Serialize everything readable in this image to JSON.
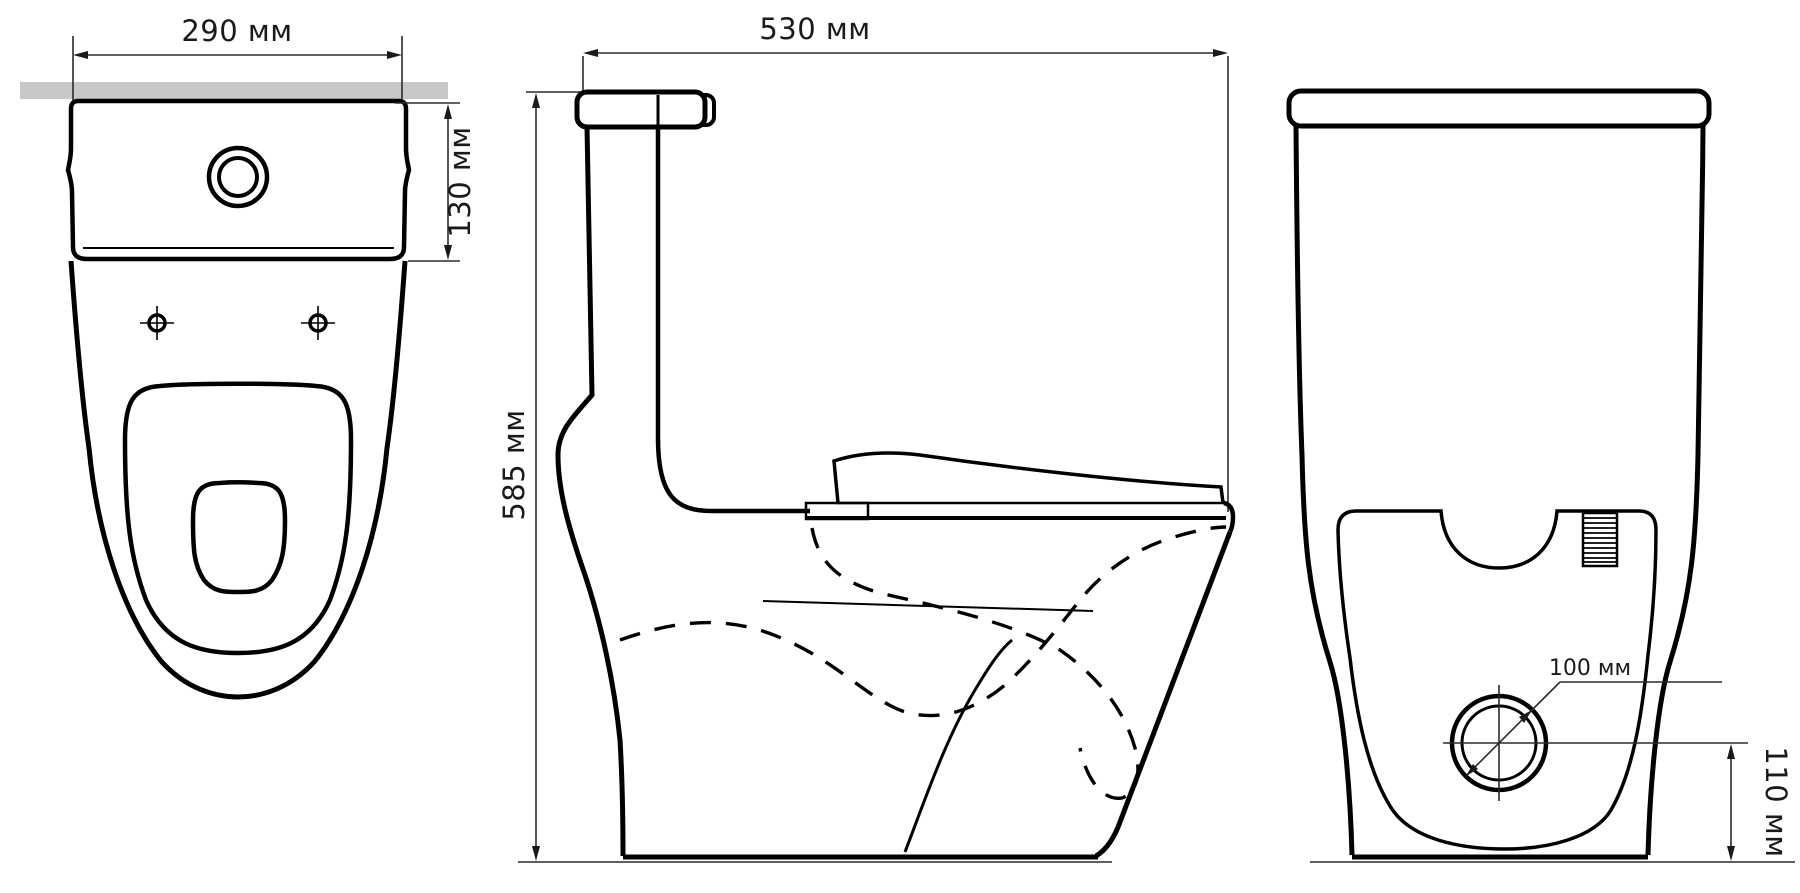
{
  "drawing": {
    "kind": "technical dimensional drawing",
    "subject": "one-piece toilet shown in three orthographic views (top, side, front)",
    "unit": "мм",
    "dimensions": {
      "top_width": "290 мм",
      "tank_depth": "130 мм",
      "side_depth": "530 мм",
      "side_height": "585 мм",
      "outlet_diameter": "100 мм",
      "outlet_center_height": "110 мм"
    },
    "colors": {
      "outline": "#000000",
      "dimension_line": "#2b2b2b",
      "wall_bar": "#c7c7c7",
      "background": "#ffffff"
    }
  }
}
